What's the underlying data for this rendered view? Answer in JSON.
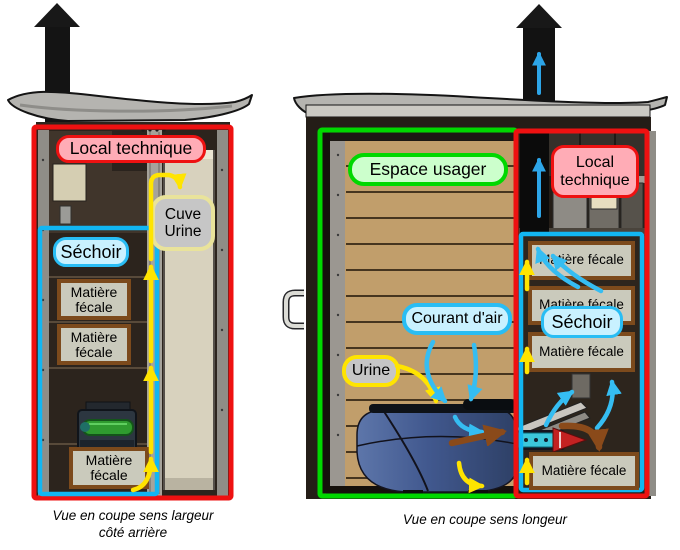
{
  "colors": {
    "zone_red": "#ee1111",
    "zone_green": "#00d800",
    "zone_cyan": "#12b6f2",
    "pink_label_bg": "#ffacb6",
    "green_label_bg": "#ccffcc",
    "cyan_label_bg": "#c9f1ff",
    "gray_label_bg": "#c6c6c6",
    "pale_yellow_border": "#e9e39b",
    "yellow_arrow": "#ffe400",
    "cyan_arrow": "#35bdf2",
    "blue_arrow": "#2da5e8",
    "brown_arrow": "#8a4a1a",
    "fecal_box_bg": "#cacabc",
    "fecal_box_border": "#7c4a1c"
  },
  "left_figure": {
    "zones": {
      "local_technique": "Local technique",
      "sechoir": "Séchoir"
    },
    "tank_label": "Cuve\nUrine",
    "fecal_boxes": [
      "Matière\nfécale",
      "Matière\nfécale",
      "Matière\nfécale"
    ],
    "caption": "Vue en coupe sens largeur\ncôté arrière"
  },
  "right_figure": {
    "zones": {
      "espace_usager": "Espace usager",
      "local_technique": "Local\ntechnique",
      "sechoir": "Séchoir"
    },
    "flow_labels": {
      "courant_air": "Courant d'air",
      "urine": "Urine"
    },
    "fecal_boxes": [
      "Matière fécale",
      "Matière fécale",
      "Matière fécale",
      "Matière fécale"
    ],
    "caption": "Vue en coupe sens longeur"
  }
}
